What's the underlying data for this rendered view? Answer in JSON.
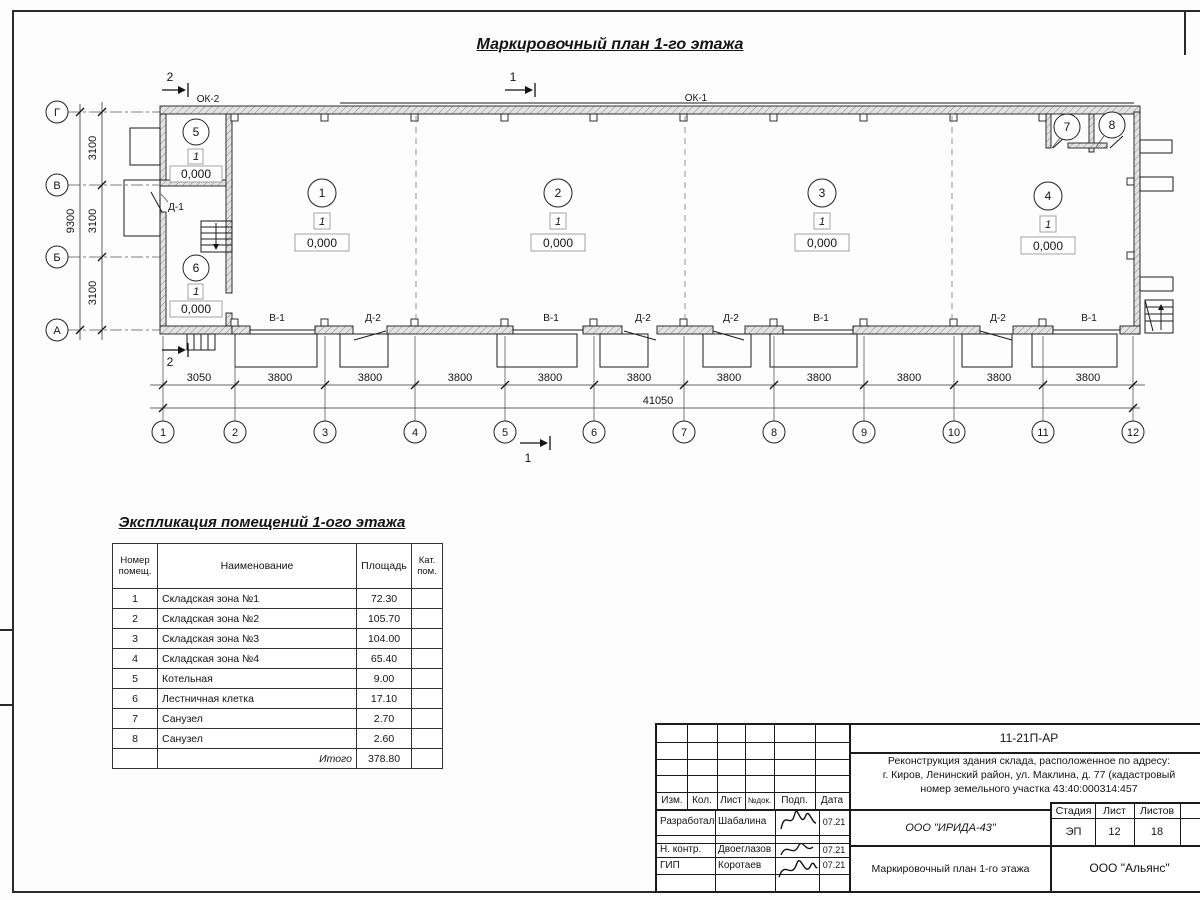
{
  "title": "Маркировочный план 1-го этажа",
  "plan": {
    "window_labels": {
      "ok2": "ОК-2",
      "ok1": "ОК-1"
    },
    "door_label_d1": "Д-1",
    "section_marks": {
      "mark1": "1",
      "mark2": "2"
    },
    "rooms": [
      {
        "num": "1",
        "floor": "1",
        "level": "0,000"
      },
      {
        "num": "2",
        "floor": "1",
        "level": "0,000"
      },
      {
        "num": "3",
        "floor": "1",
        "level": "0,000"
      },
      {
        "num": "4",
        "floor": "1",
        "level": "0,000"
      },
      {
        "num": "5",
        "floor": "1",
        "level": "0,000"
      },
      {
        "num": "6",
        "floor": "1",
        "level": "0,000"
      },
      {
        "num": "7"
      },
      {
        "num": "8"
      }
    ],
    "bottom_labels": [
      "В-1",
      "Д-2",
      "В-1",
      "Д-2",
      "Д-2",
      "В-1",
      "Д-2",
      "В-1"
    ],
    "dims_bottom": [
      "3050",
      "3800",
      "3800",
      "3800",
      "3800",
      "3800",
      "3800",
      "3800",
      "3800",
      "3800",
      "3800"
    ],
    "dim_total_bottom": "41050",
    "dims_left": [
      "3100",
      "3100",
      "3100"
    ],
    "dim_total_left": "9300",
    "axes_bottom": [
      "1",
      "2",
      "3",
      "4",
      "5",
      "6",
      "7",
      "8",
      "9",
      "10",
      "11",
      "12"
    ],
    "axes_left": [
      "Г",
      "В",
      "Б",
      "А"
    ]
  },
  "schedule": {
    "title": "Экспликация помещений 1-ого этажа",
    "headers": [
      "Номер помещ.",
      "Наименование",
      "Площадь",
      "Кат. пом."
    ],
    "rows": [
      [
        "1",
        "Складская зона №1",
        "72.30"
      ],
      [
        "2",
        "Складская зона №2",
        "105.70"
      ],
      [
        "3",
        "Складская зона №3",
        "104.00"
      ],
      [
        "4",
        "Складская зона №4",
        "65.40"
      ],
      [
        "5",
        "Котельная",
        "9.00"
      ],
      [
        "6",
        "Лестничная клетка",
        "17.10"
      ],
      [
        "7",
        "Санузел",
        "2.70"
      ],
      [
        "8",
        "Санузел",
        "2.60"
      ]
    ],
    "total_label": "Итого",
    "total_value": "378.80"
  },
  "titleblock": {
    "doc_number": "11-21П-АР",
    "project_line1": "Реконструкция здания склада, расположенное по адресу:",
    "project_line2": "г. Киров, Ленинский район, ул. Маклина, д. 77 (кадастровый",
    "project_line3": "номер земельного участка 43:40:000314:457",
    "header_cells": [
      "Изм.",
      "Кол.",
      "Лист",
      "№док.",
      "Подп.",
      "Дата"
    ],
    "roles": [
      {
        "role": "Разработал",
        "name": "Шабалина",
        "date": "07.21"
      },
      {
        "role": "Н. контр.",
        "name": "Двоеглазов",
        "date": "07.21"
      },
      {
        "role": "ГИП",
        "name": "Коротаев",
        "date": "07.21"
      }
    ],
    "company": "ООО \"ИРИДА-43\"",
    "stage_headers": [
      "Стадия",
      "Лист",
      "Листов"
    ],
    "stage_values": [
      "ЭП",
      "12",
      "18"
    ],
    "sheet_title": "Маркировочный план 1-го этажа",
    "contractor": "ООО \"Альянс\""
  }
}
